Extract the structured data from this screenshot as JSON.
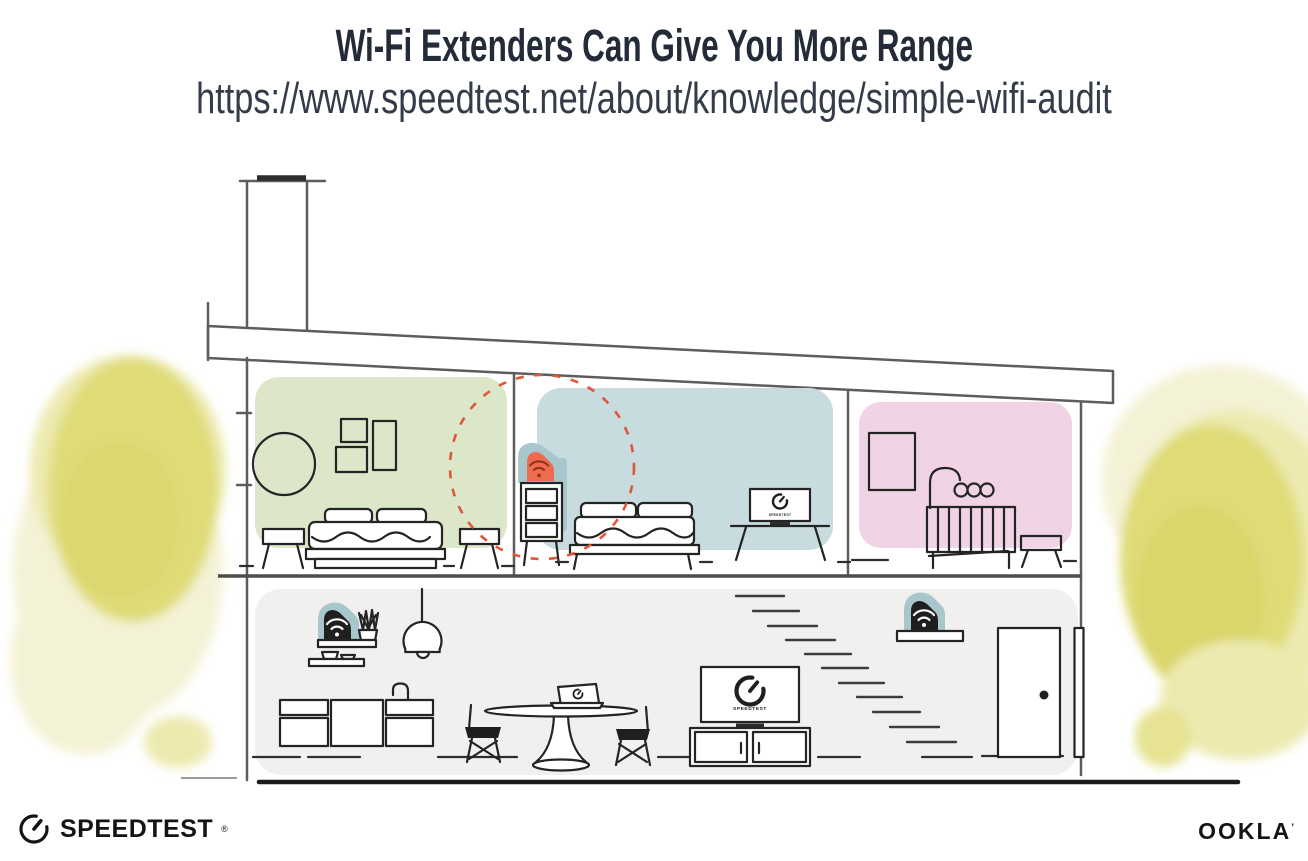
{
  "header": {
    "title": "Wi-Fi Extenders Can Give You More Range",
    "url": "https://www.speedtest.net/about/knowledge/simple-wifi-audit"
  },
  "scene": {
    "speedtest_screen_label": "SPEEDTEST",
    "colors": {
      "green_room": "#dbe7c8",
      "blue_room": "#c8dce0",
      "pink_room": "#f0d3e5",
      "ground_floor": "#f1f0ee",
      "device_halo_teal": "#a7c7cd",
      "extender_orange": "#ee6b4d",
      "extender_wifi_dark": "#8c2f1b",
      "coverage_dashed_red": "#e0563a",
      "foliage_yellow": "#dfdc78",
      "foliage_yellow_light": "#edeab0",
      "foliage_yellow_pale": "#f4f2d6"
    },
    "objects": {
      "extender": "wifi-extender-on-dresser",
      "router_kitchen": "wifi-router-kitchen-shelf",
      "router_living": "wifi-router-living-shelf"
    }
  },
  "footer": {
    "speedtest_wordmark": "SPEEDTEST",
    "speedtest_reg_mark": "®",
    "ookla_wordmark": "OOKLA",
    "ookla_reg_mark": "’"
  }
}
